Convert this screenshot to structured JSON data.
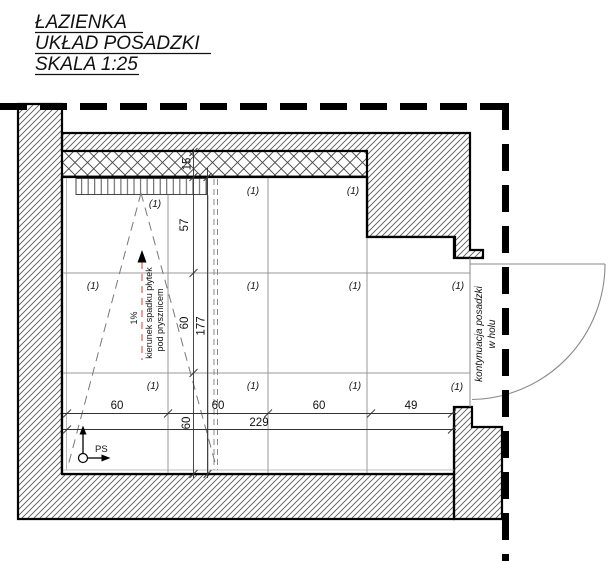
{
  "title": {
    "line1": "ŁAZIENKA",
    "line2": "UKŁAD POSADZKI",
    "line3": "SKALA 1:25"
  },
  "dims": {
    "h_segments": [
      "60",
      "60",
      "60",
      "49"
    ],
    "h_total": "229",
    "v_wall_strip": "15",
    "v_segments": [
      "57",
      "60",
      "60"
    ],
    "v_total": "177"
  },
  "tile_labels": [
    "(1)",
    "(1)",
    "(1)",
    "(1)",
    "(1)",
    "(1)",
    "(1)",
    "(1)",
    "(1)",
    "(1)",
    "(1)"
  ],
  "slope_note": {
    "percent": "1%",
    "line1": "kierunek spadku płytek",
    "line2": "pod prysznicem"
  },
  "door_note": {
    "line1": "kontynuacja posadzki",
    "line2": "w holu"
  },
  "origin": {
    "label": "PS"
  },
  "colors": {
    "slope_arrow_red": "#ee928e",
    "line_black": "#000000",
    "grid_gray": "#999999",
    "hatch_gray": "#5a5a5a"
  }
}
